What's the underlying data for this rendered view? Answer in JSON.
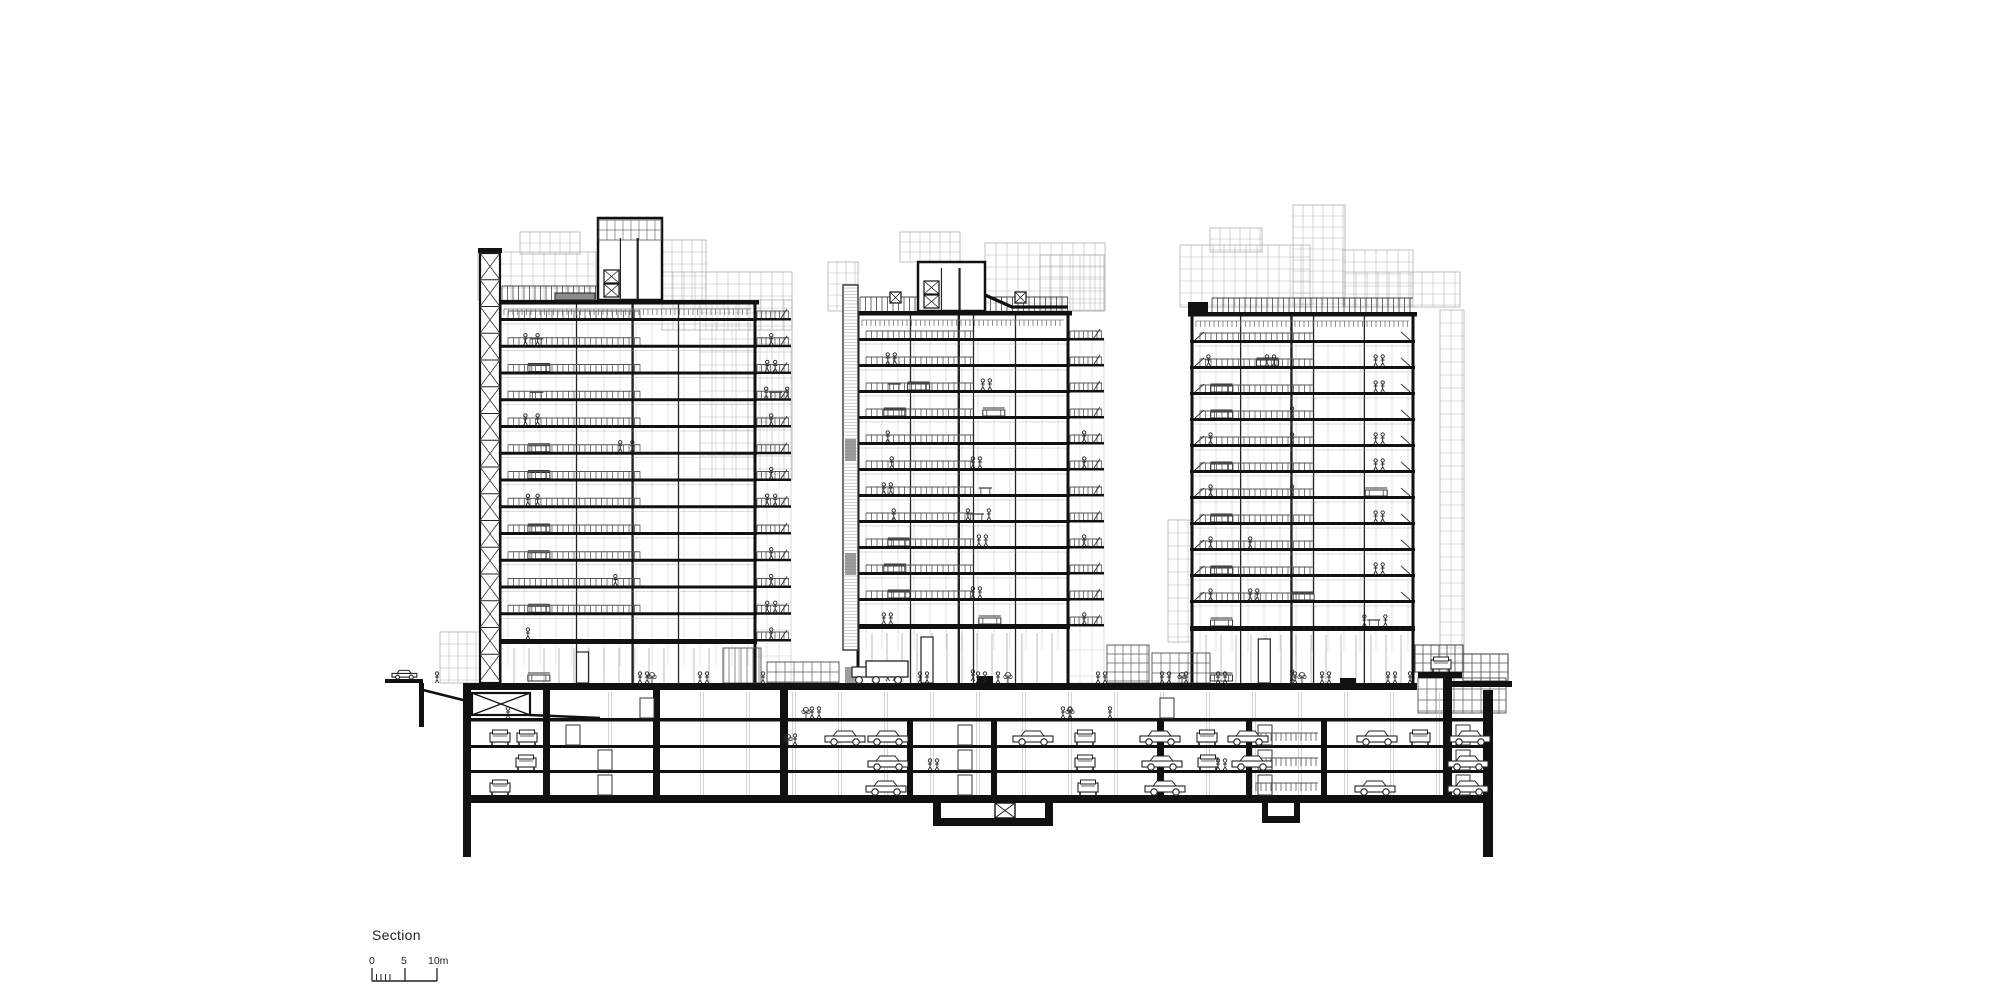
{
  "meta": {
    "title_label": "Section",
    "scale": {
      "labels": [
        "0",
        "5",
        "10m"
      ],
      "bar_x0": 372,
      "bar_x5": 405,
      "bar_x10": 437,
      "bar_y": 981,
      "major_tick_h": 13,
      "minor_ticks_x": [
        376.5,
        381,
        385.5,
        390
      ],
      "minor_tick_h": 7
    }
  },
  "colors": {
    "ink": "#111111",
    "mid": "#444444",
    "light": "#9a9a9a",
    "faint": "#b9b9b9",
    "grid": "#a8a8a8",
    "dark_fill": "#8c8c8c",
    "white": "#ffffff"
  },
  "towers": [
    {
      "name": "left-tower",
      "body": {
        "x": 500,
        "w": 255,
        "roof": 300,
        "floor_top": 318,
        "floors": 13,
        "spacing": 26.75,
        "ground": 683
      },
      "walls_fx": [
        0.3,
        0.52,
        0.7
      ],
      "core": {
        "type": "xshaft",
        "x": 480,
        "w": 20,
        "top": 253
      },
      "balcony": {
        "side": "right",
        "x": 755,
        "w": 36,
        "top": 344
      },
      "penthouse": {
        "x": 598,
        "w": 64,
        "top": 218,
        "band_h": 20
      },
      "roof_rail": [
        [
          502,
          598
        ]
      ],
      "roof_patch": {
        "x": 555,
        "w": 40
      },
      "gray_blocks": [
        [
          478,
          252,
          118,
          48,
          11,
          12
        ],
        [
          520,
          232,
          60,
          22,
          10,
          11
        ],
        [
          662,
          240,
          44,
          60,
          10,
          12
        ],
        [
          662,
          272,
          130,
          58,
          11,
          12
        ],
        [
          700,
          300,
          92,
          180,
          12,
          13
        ],
        [
          440,
          632,
          42,
          51,
          9,
          12
        ]
      ],
      "items": [
        "p:0.08|p:0.13|tbl:0.10|bp:1",
        "sofa:0.09|bp2:1",
        "tbl:0.10|bpt:1",
        "p:0.08|p:0.13|bp:1",
        "sofa:0.09|p:0.47|p:0.52",
        "sofa:0.09|bp:1",
        "p:0.09|p:0.13|bp2:1",
        "sofa:0.09",
        "sofa:0.09|bp:1",
        "p:0.45|bp:1",
        "sofa:0.09|bp2:1",
        "p:0.09|bp:1",
        "sofa:0.09"
      ]
    },
    {
      "name": "middle-tower",
      "body": {
        "x": 858,
        "w": 210,
        "roof": 311,
        "floor_top": 338,
        "floors": 12,
        "spacing": 26.0,
        "ground": 683
      },
      "walls_fx": [
        0.25,
        0.48,
        0.55,
        0.75
      ],
      "core": {
        "type": "stripes",
        "x": 843,
        "w": 15,
        "top": 285
      },
      "balcony": {
        "side": "right",
        "x": 1068,
        "w": 36,
        "top": 338
      },
      "penthouse": {
        "x": 918,
        "w": 67,
        "top": 262,
        "band_h": 0
      },
      "slope_canopy": [
        [
          985,
          295
        ],
        [
          1012,
          307
        ],
        [
          1068,
          307
        ]
      ],
      "roof_rail": [
        [
          860,
          918
        ],
        [
          985,
          1068
        ]
      ],
      "xdoors": [
        [
          890,
          292
        ],
        [
          1015,
          292
        ]
      ],
      "gray_blocks": [
        [
          828,
          262,
          30,
          49,
          9,
          11
        ],
        [
          985,
          243,
          120,
          68,
          11,
          12
        ],
        [
          900,
          232,
          60,
          30,
          10,
          10
        ],
        [
          1040,
          255,
          64,
          56,
          10,
          11
        ]
      ],
      "items": [
        "p2:0.12",
        "sofa:0.22|tbl:0.12|p2:0.60",
        "sofa:0.10|sofa:0.60",
        "p:0.12|bp:1",
        "p:0.14|p2:0.55|bp:1",
        "p2:0.10|tbl:0.58",
        "p:0.15|pt:0.55",
        "sofa:0.12|p2:0.58|bp:1",
        "sofa:0.10",
        "sofa:0.12|p2:0.55",
        "p2:0.10|sofa:0.58|bp:1",
        "p2:0.12|p:0.55",
        "sofa:0.12|p:0.40"
      ]
    },
    {
      "name": "right-tower",
      "body": {
        "x": 1192,
        "w": 221,
        "roof": 312,
        "floor_top": 340,
        "floors": 12,
        "spacing": 26.0,
        "ground": 683
      },
      "walls_fx": [
        0.22,
        0.45,
        0.55,
        0.78
      ],
      "core": null,
      "balcony": null,
      "penthouse": null,
      "parapet_step": {
        "x": 1192,
        "w": 20
      },
      "roof_rail": [
        [
          1212,
          1413
        ]
      ],
      "edge_braces": true,
      "gray_blocks": [
        [
          1180,
          245,
          130,
          62,
          11,
          12
        ],
        [
          1210,
          228,
          52,
          24,
          10,
          11
        ],
        [
          1293,
          205,
          52,
          102,
          10,
          11
        ],
        [
          1343,
          250,
          70,
          57,
          11,
          12
        ],
        [
          1345,
          272,
          115,
          35,
          11,
          11
        ],
        [
          1440,
          310,
          24,
          362,
          11,
          13
        ],
        [
          1168,
          520,
          24,
          122,
          10,
          13
        ]
      ],
      "items": [
        "p:0.05|sofa:0.28|p2:0.33|p2:0.85",
        "sofa:0.06|p2:0.85",
        "sofa:0.06|p:0.45",
        "p:0.06|p:0.45|p2:0.85",
        "sofa:0.06|p2:0.85",
        "p:0.06|p:0.45|sofa:0.80",
        "sofa:0.06|p2:0.85",
        "p:0.06|p:0.25",
        "sofa:0.06|p2:0.85",
        "p:0.06|p2:0.25|sofa:0.45",
        "sofa:0.06|pt:0.82",
        "sofa:0.06|p:0.45",
        "p2:0.25"
      ]
    }
  ],
  "podium": {
    "slab": {
      "x1": 463,
      "x2": 1417,
      "y": 683,
      "h": 7
    },
    "street_left": {
      "x1": 385,
      "x2": 423,
      "y": 679,
      "h": 4,
      "car_x": 392,
      "wall": [
        419,
        683,
        727
      ]
    },
    "ramp": [
      [
        423,
        690
      ],
      [
        463,
        700
      ],
      [
        530,
        715
      ],
      [
        600,
        718
      ]
    ],
    "kiosks": [
      {
        "x": 723,
        "w": 38,
        "y": 648,
        "h": 35,
        "cw": 6,
        "ch": 35
      },
      {
        "x": 767,
        "w": 72,
        "y": 662,
        "h": 21,
        "cw": 9,
        "ch": 10
      },
      {
        "x": 1107,
        "w": 42,
        "y": 645,
        "h": 38,
        "cw": 8,
        "ch": 9
      },
      {
        "x": 1152,
        "w": 58,
        "y": 653,
        "h": 30,
        "cw": 9,
        "ch": 10
      }
    ],
    "right_pavilion": {
      "deck": {
        "x": 1418,
        "w": 44,
        "y": 672,
        "h": 6,
        "car_x": 1431
      },
      "street": {
        "x": 1452,
        "w": 60,
        "y": 681,
        "h": 6
      },
      "glass_box": {
        "x": 1418,
        "w": 88,
        "y": 678,
        "h": 35,
        "cw": 9,
        "ch": 11
      },
      "upper_boxes": [
        {
          "x": 1415,
          "w": 48,
          "y": 645,
          "h": 27,
          "cw": 8,
          "ch": 9
        },
        {
          "x": 1463,
          "w": 45,
          "y": 654,
          "h": 27,
          "cw": 9,
          "ch": 9
        }
      ]
    },
    "people_groups": [
      {
        "x": 437,
        "n": 1
      },
      {
        "x": 640,
        "n": 2
      },
      {
        "x": 700,
        "n": 2
      },
      {
        "x": 763,
        "n": 1
      },
      {
        "x": 920,
        "n": 2
      },
      {
        "x": 978,
        "n": 2
      },
      {
        "x": 998,
        "n": 1
      },
      {
        "x": 1098,
        "n": 2
      },
      {
        "x": 1162,
        "n": 2
      },
      {
        "x": 1186,
        "n": 1
      },
      {
        "x": 1218,
        "n": 2
      },
      {
        "x": 1295,
        "n": 1
      },
      {
        "x": 1322,
        "n": 2
      },
      {
        "x": 1388,
        "n": 2
      },
      {
        "x": 1410,
        "n": 1
      }
    ],
    "plants": [
      652,
      1008,
      1182,
      1302
    ],
    "truck_x": 852,
    "curbs": [
      [
        977,
        676,
        16,
        7
      ],
      [
        1340,
        678,
        16,
        5
      ]
    ]
  },
  "basement": {
    "left_wall": {
      "x": 463,
      "w": 8,
      "y2": 857
    },
    "right_wall": {
      "x": 1483,
      "w": 10,
      "y2": 857
    },
    "b1_floor": 718,
    "p1_floor": 745,
    "p2_floor": 770,
    "bottom_top": 795,
    "bottom_h": 8,
    "bottom_x1": 463,
    "bottom_x2": 1493,
    "xroom": {
      "x": 472,
      "y": 693,
      "w": 58,
      "h": 22
    },
    "walls": [
      [
        543,
        7,
        690,
        795
      ],
      [
        653,
        7,
        690,
        795
      ],
      [
        780,
        8,
        683,
        795
      ],
      [
        907,
        6,
        718,
        795
      ],
      [
        991,
        6,
        718,
        795
      ],
      [
        1157,
        7,
        718,
        795
      ],
      [
        1246,
        6,
        718,
        795
      ],
      [
        1321,
        6,
        718,
        795
      ],
      [
        1443,
        9,
        678,
        795
      ]
    ],
    "pits": [
      {
        "x1": 933,
        "x2": 1053,
        "wall_w": 8,
        "depth": 818,
        "floor_h": 8,
        "xbox": [
          995,
          803,
          20,
          15
        ]
      },
      {
        "x1": 1262,
        "x2": 1300,
        "wall_w": 6,
        "depth": 816,
        "floor_h": 7,
        "xbox": null
      }
    ],
    "columns": {
      "x1": 610,
      "x2": 1470,
      "step": 46,
      "y1": 692,
      "y2": 795
    },
    "doors": [
      [
        566,
        745
      ],
      [
        598,
        770
      ],
      [
        598,
        795
      ],
      [
        958,
        745
      ],
      [
        958,
        770
      ],
      [
        958,
        795
      ],
      [
        1258,
        745
      ],
      [
        1258,
        770
      ],
      [
        1258,
        795
      ],
      [
        1456,
        745
      ],
      [
        1456,
        770
      ],
      [
        1456,
        795
      ],
      [
        640,
        718
      ],
      [
        1160,
        718
      ]
    ],
    "stair_bands": [
      [
        1256,
        1318,
        733
      ],
      [
        1256,
        1318,
        758
      ],
      [
        1256,
        1318,
        783
      ]
    ],
    "cars": [
      {
        "lvl": 745,
        "t": "f",
        "x": 490
      },
      {
        "lvl": 745,
        "t": "f",
        "x": 517
      },
      {
        "lvl": 745,
        "t": "s",
        "x": 825
      },
      {
        "lvl": 745,
        "t": "s",
        "x": 868
      },
      {
        "lvl": 745,
        "t": "s",
        "x": 1013
      },
      {
        "lvl": 745,
        "t": "f",
        "x": 1075
      },
      {
        "lvl": 745,
        "t": "s",
        "x": 1140
      },
      {
        "lvl": 745,
        "t": "f",
        "x": 1197
      },
      {
        "lvl": 745,
        "t": "s",
        "x": 1228
      },
      {
        "lvl": 745,
        "t": "s",
        "x": 1357
      },
      {
        "lvl": 745,
        "t": "f",
        "x": 1410
      },
      {
        "lvl": 745,
        "t": "s",
        "x": 1450
      },
      {
        "lvl": 770,
        "t": "f",
        "x": 516
      },
      {
        "lvl": 770,
        "t": "s",
        "x": 868
      },
      {
        "lvl": 770,
        "t": "f",
        "x": 1075
      },
      {
        "lvl": 770,
        "t": "s",
        "x": 1142
      },
      {
        "lvl": 770,
        "t": "f",
        "x": 1198
      },
      {
        "lvl": 770,
        "t": "s",
        "x": 1232
      },
      {
        "lvl": 770,
        "t": "s",
        "x": 1448
      },
      {
        "lvl": 795,
        "t": "f",
        "x": 490
      },
      {
        "lvl": 795,
        "t": "s",
        "x": 866
      },
      {
        "lvl": 795,
        "t": "f",
        "x": 1078
      },
      {
        "lvl": 795,
        "t": "s",
        "x": 1145
      },
      {
        "lvl": 795,
        "t": "s",
        "x": 1355
      },
      {
        "lvl": 795,
        "t": "s",
        "x": 1448
      }
    ],
    "people": [
      {
        "x": 812,
        "y": 718,
        "n": 2
      },
      {
        "x": 1063,
        "y": 718,
        "n": 2
      },
      {
        "x": 1110,
        "y": 718,
        "n": 1
      },
      {
        "x": 795,
        "y": 745,
        "n": 1
      },
      {
        "x": 930,
        "y": 770,
        "n": 2
      },
      {
        "x": 1218,
        "y": 770,
        "n": 2
      },
      {
        "x": 508,
        "y": 718,
        "n": 1
      }
    ],
    "plants": [
      [
        806,
        718
      ],
      [
        788,
        745
      ],
      [
        1070,
        718
      ]
    ]
  }
}
